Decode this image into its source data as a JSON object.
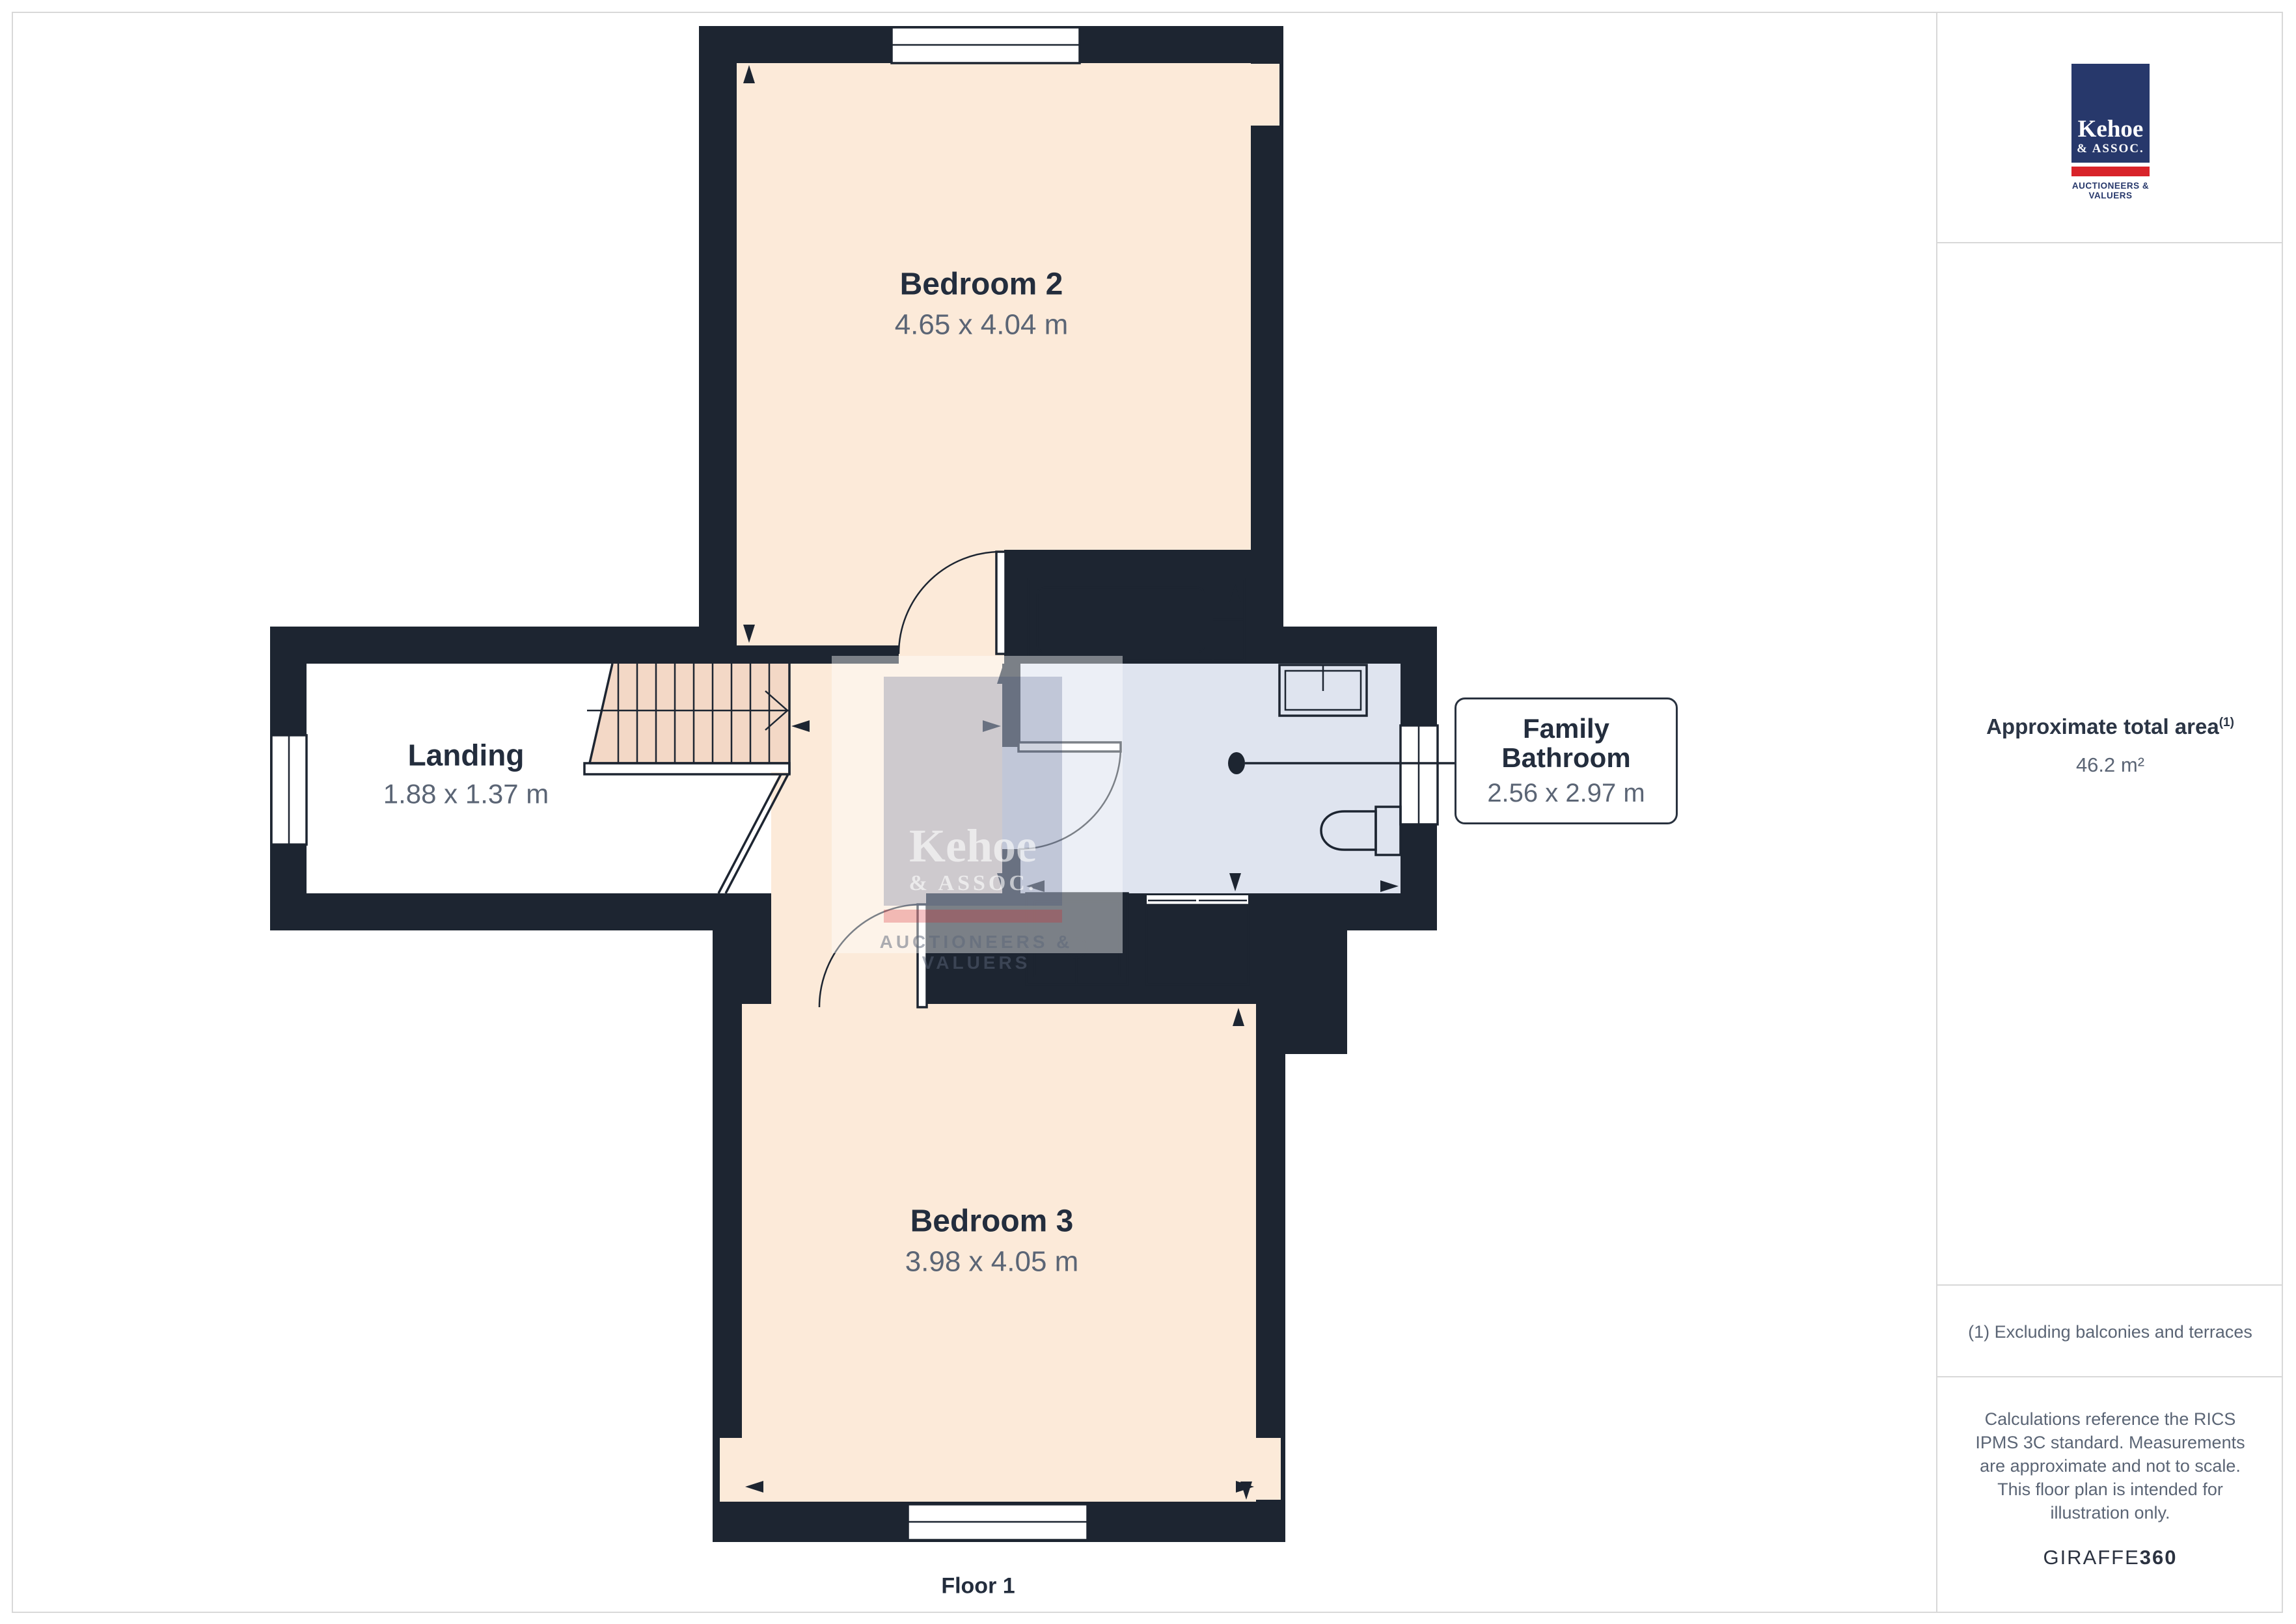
{
  "floor_label": "Floor 1",
  "plan": {
    "bedroom2": {
      "name": "Bedroom 2",
      "dims": "4.65 x 4.04 m"
    },
    "landing": {
      "name": "Landing",
      "dims": "1.88 x 1.37 m"
    },
    "bedroom3": {
      "name": "Bedroom 3",
      "dims": "3.98 x 4.05 m"
    },
    "bathroom": {
      "name_line1": "Family",
      "name_line2": "Bathroom",
      "dims": "2.56 x 2.97 m"
    }
  },
  "sidebar": {
    "logo": {
      "name": "Kehoe",
      "suffix": "& ASSOC.",
      "tagline": "AUCTIONEERS & VALUERS"
    },
    "area_label": "Approximate total area",
    "area_footnote_mark": "(1)",
    "area_value": "46.2 m²",
    "footnote": "(1) Excluding balconies and terraces",
    "disclaimer": "Calculations reference the RICS IPMS 3C standard. Measurements are approximate and not to scale. This floor plan is intended for illustration only.",
    "brand": {
      "light": "GIRAFFE",
      "bold": "360"
    }
  },
  "watermark": {
    "name": "Kehoe",
    "suffix": "& ASSOC.",
    "tagline": "AUCTIONEERS & VALUERS"
  },
  "colors": {
    "wall": "#1d2531",
    "bedroom_fill": "#fcead9",
    "stair_fill": "#f3d8c6",
    "bathroom_fill": "#dfe4ef",
    "fixture_fill": "#e9edf6",
    "utility_fill": "#cfcfd0",
    "logo_navy": "#27386b",
    "logo_red": "#d8232a",
    "text_dark": "#232d3d",
    "text_gray": "#5b6575",
    "frame": "#d8d8d8"
  }
}
